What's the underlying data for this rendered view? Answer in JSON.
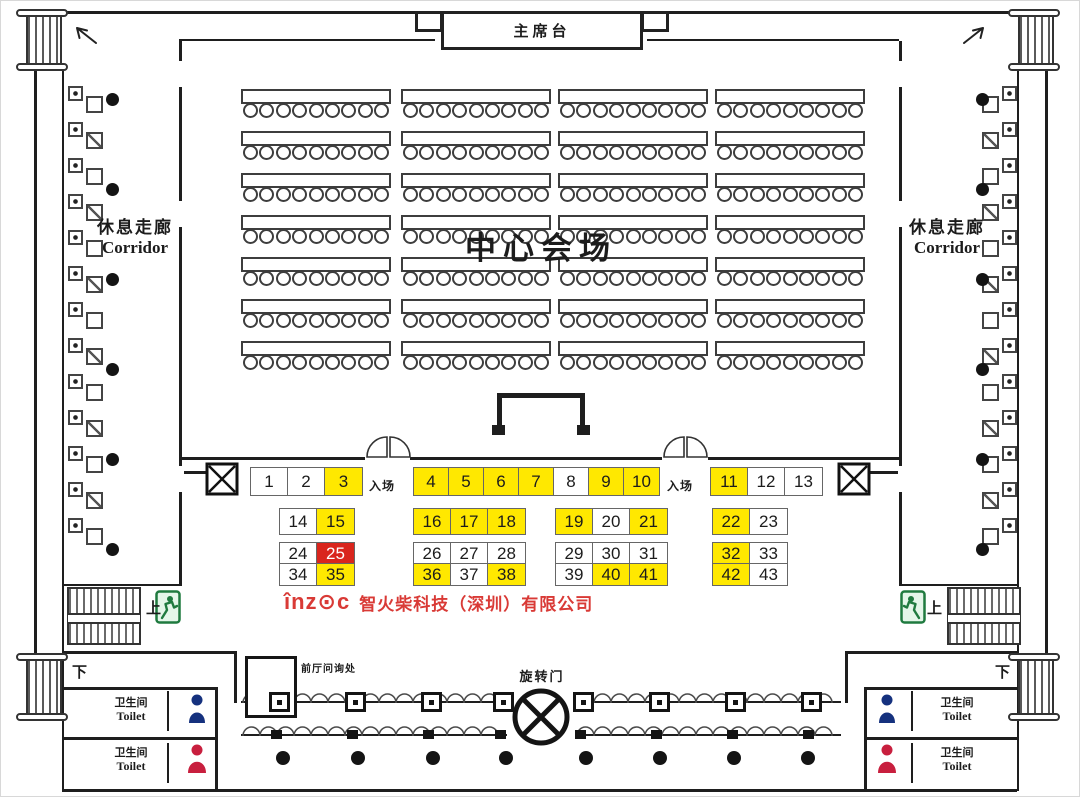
{
  "stage": {
    "label": "主席台"
  },
  "hall": {
    "label": "中心会场"
  },
  "corridor": {
    "cn": "休息走廊",
    "en": "Corridor"
  },
  "entrance": {
    "label": "入场"
  },
  "directions": {
    "up": "上",
    "down": "下"
  },
  "revolving_door": {
    "label": "旋转门"
  },
  "info_desk": {
    "label": "前厅问询处"
  },
  "toilet": {
    "cn": "卫生间",
    "en": "Toilet"
  },
  "company": {
    "logo": "înz⊙c",
    "name": "智火柴科技（深圳）有限公司",
    "color": "#d93a36"
  },
  "icons": {
    "exit": "running-man-exit",
    "male": "male-silhouette",
    "female": "female-silhouette",
    "column": "x-box-column",
    "door": "revolving-door"
  },
  "seating": {
    "rows": 7,
    "columns": 4,
    "seats_per_table": 9
  },
  "booths": {
    "colors": {
      "available": "#ffffff",
      "reserved": "#ffe800",
      "highlight": "#d9251d"
    },
    "rows": [
      {
        "y": 466,
        "h": 27,
        "groups": [
          {
            "x": 249,
            "w": 37,
            "cells": [
              {
                "n": "1",
                "s": "available"
              },
              {
                "n": "2",
                "s": "available"
              },
              {
                "n": "3",
                "s": "reserved"
              }
            ]
          },
          {
            "x": 412,
            "w": 35,
            "cells": [
              {
                "n": "4",
                "s": "reserved"
              },
              {
                "n": "5",
                "s": "reserved"
              },
              {
                "n": "6",
                "s": "reserved"
              },
              {
                "n": "7",
                "s": "reserved"
              },
              {
                "n": "8",
                "s": "available"
              },
              {
                "n": "9",
                "s": "reserved"
              },
              {
                "n": "10",
                "s": "reserved"
              }
            ]
          },
          {
            "x": 709,
            "w": 37,
            "cells": [
              {
                "n": "11",
                "s": "reserved"
              },
              {
                "n": "12",
                "s": "available"
              },
              {
                "n": "13",
                "s": "available"
              }
            ]
          }
        ]
      },
      {
        "y": 507,
        "h": 25,
        "groups": [
          {
            "x": 278,
            "w": 37,
            "cells": [
              {
                "n": "14",
                "s": "available"
              },
              {
                "n": "15",
                "s": "reserved"
              }
            ]
          },
          {
            "x": 412,
            "w": 37,
            "cells": [
              {
                "n": "16",
                "s": "reserved"
              },
              {
                "n": "17",
                "s": "reserved"
              },
              {
                "n": "18",
                "s": "reserved"
              }
            ]
          },
          {
            "x": 554,
            "w": 37,
            "cells": [
              {
                "n": "19",
                "s": "reserved"
              },
              {
                "n": "20",
                "s": "available"
              },
              {
                "n": "21",
                "s": "reserved"
              }
            ]
          },
          {
            "x": 711,
            "w": 37,
            "cells": [
              {
                "n": "22",
                "s": "reserved"
              },
              {
                "n": "23",
                "s": "available"
              }
            ]
          }
        ]
      },
      {
        "y": 541,
        "h": 21,
        "groups": [
          {
            "x": 278,
            "w": 37,
            "cells": [
              {
                "n": "24",
                "s": "available"
              },
              {
                "n": "25",
                "s": "highlight"
              }
            ]
          },
          {
            "x": 412,
            "w": 37,
            "cells": [
              {
                "n": "26",
                "s": "available"
              },
              {
                "n": "27",
                "s": "available"
              },
              {
                "n": "28",
                "s": "available"
              }
            ]
          },
          {
            "x": 554,
            "w": 37,
            "cells": [
              {
                "n": "29",
                "s": "available"
              },
              {
                "n": "30",
                "s": "available"
              },
              {
                "n": "31",
                "s": "available"
              }
            ]
          },
          {
            "x": 711,
            "w": 37,
            "cells": [
              {
                "n": "32",
                "s": "reserved"
              },
              {
                "n": "33",
                "s": "available"
              }
            ]
          }
        ]
      },
      {
        "y": 562,
        "h": 21,
        "groups": [
          {
            "x": 278,
            "w": 37,
            "cells": [
              {
                "n": "34",
                "s": "available"
              },
              {
                "n": "35",
                "s": "reserved"
              }
            ]
          },
          {
            "x": 412,
            "w": 37,
            "cells": [
              {
                "n": "36",
                "s": "reserved"
              },
              {
                "n": "37",
                "s": "available"
              },
              {
                "n": "38",
                "s": "reserved"
              }
            ]
          },
          {
            "x": 554,
            "w": 37,
            "cells": [
              {
                "n": "39",
                "s": "available"
              },
              {
                "n": "40",
                "s": "reserved"
              },
              {
                "n": "41",
                "s": "reserved"
              }
            ]
          },
          {
            "x": 711,
            "w": 37,
            "cells": [
              {
                "n": "42",
                "s": "reserved"
              },
              {
                "n": "43",
                "s": "available"
              }
            ]
          }
        ]
      }
    ]
  }
}
